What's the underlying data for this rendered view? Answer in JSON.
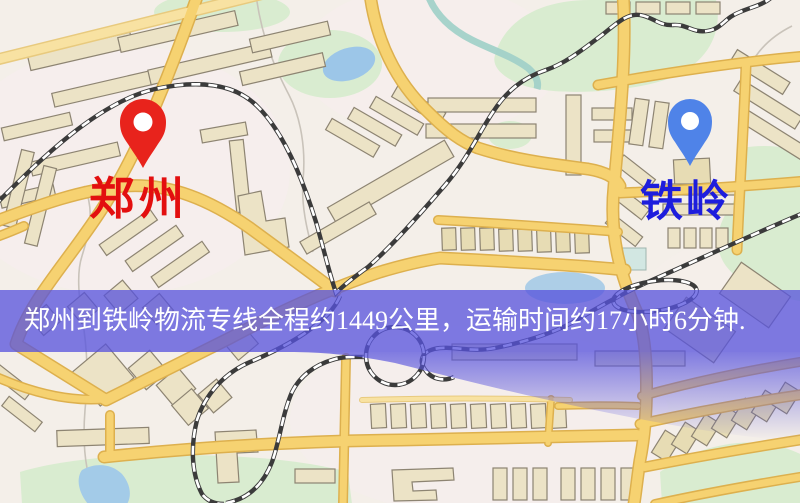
{
  "map": {
    "markers": [
      {
        "id": "origin",
        "label": "郑州",
        "pin_color": "#e8231c",
        "label_color": "#e30f0f"
      },
      {
        "id": "destination",
        "label": "铁岭",
        "pin_color": "#4f83e8",
        "label_color": "#1d1ddd"
      }
    ],
    "banner": {
      "text": "郑州到铁岭物流专线全程约1449公里，运输时间约17小时6分钟.",
      "background_color": "#5753dd",
      "text_color": "#ffffff"
    },
    "route_facts": {
      "origin": "郑州",
      "destination": "铁岭",
      "service_type": "物流专线",
      "distance_text": "约1449公里",
      "duration_text": "约17小时6分钟"
    },
    "legend_colors": {
      "road": "#f6d271",
      "railway": "#3b3b3b",
      "water": "#9cc6e8",
      "park": "#d9ecd0",
      "building": "#ece3c6"
    }
  }
}
